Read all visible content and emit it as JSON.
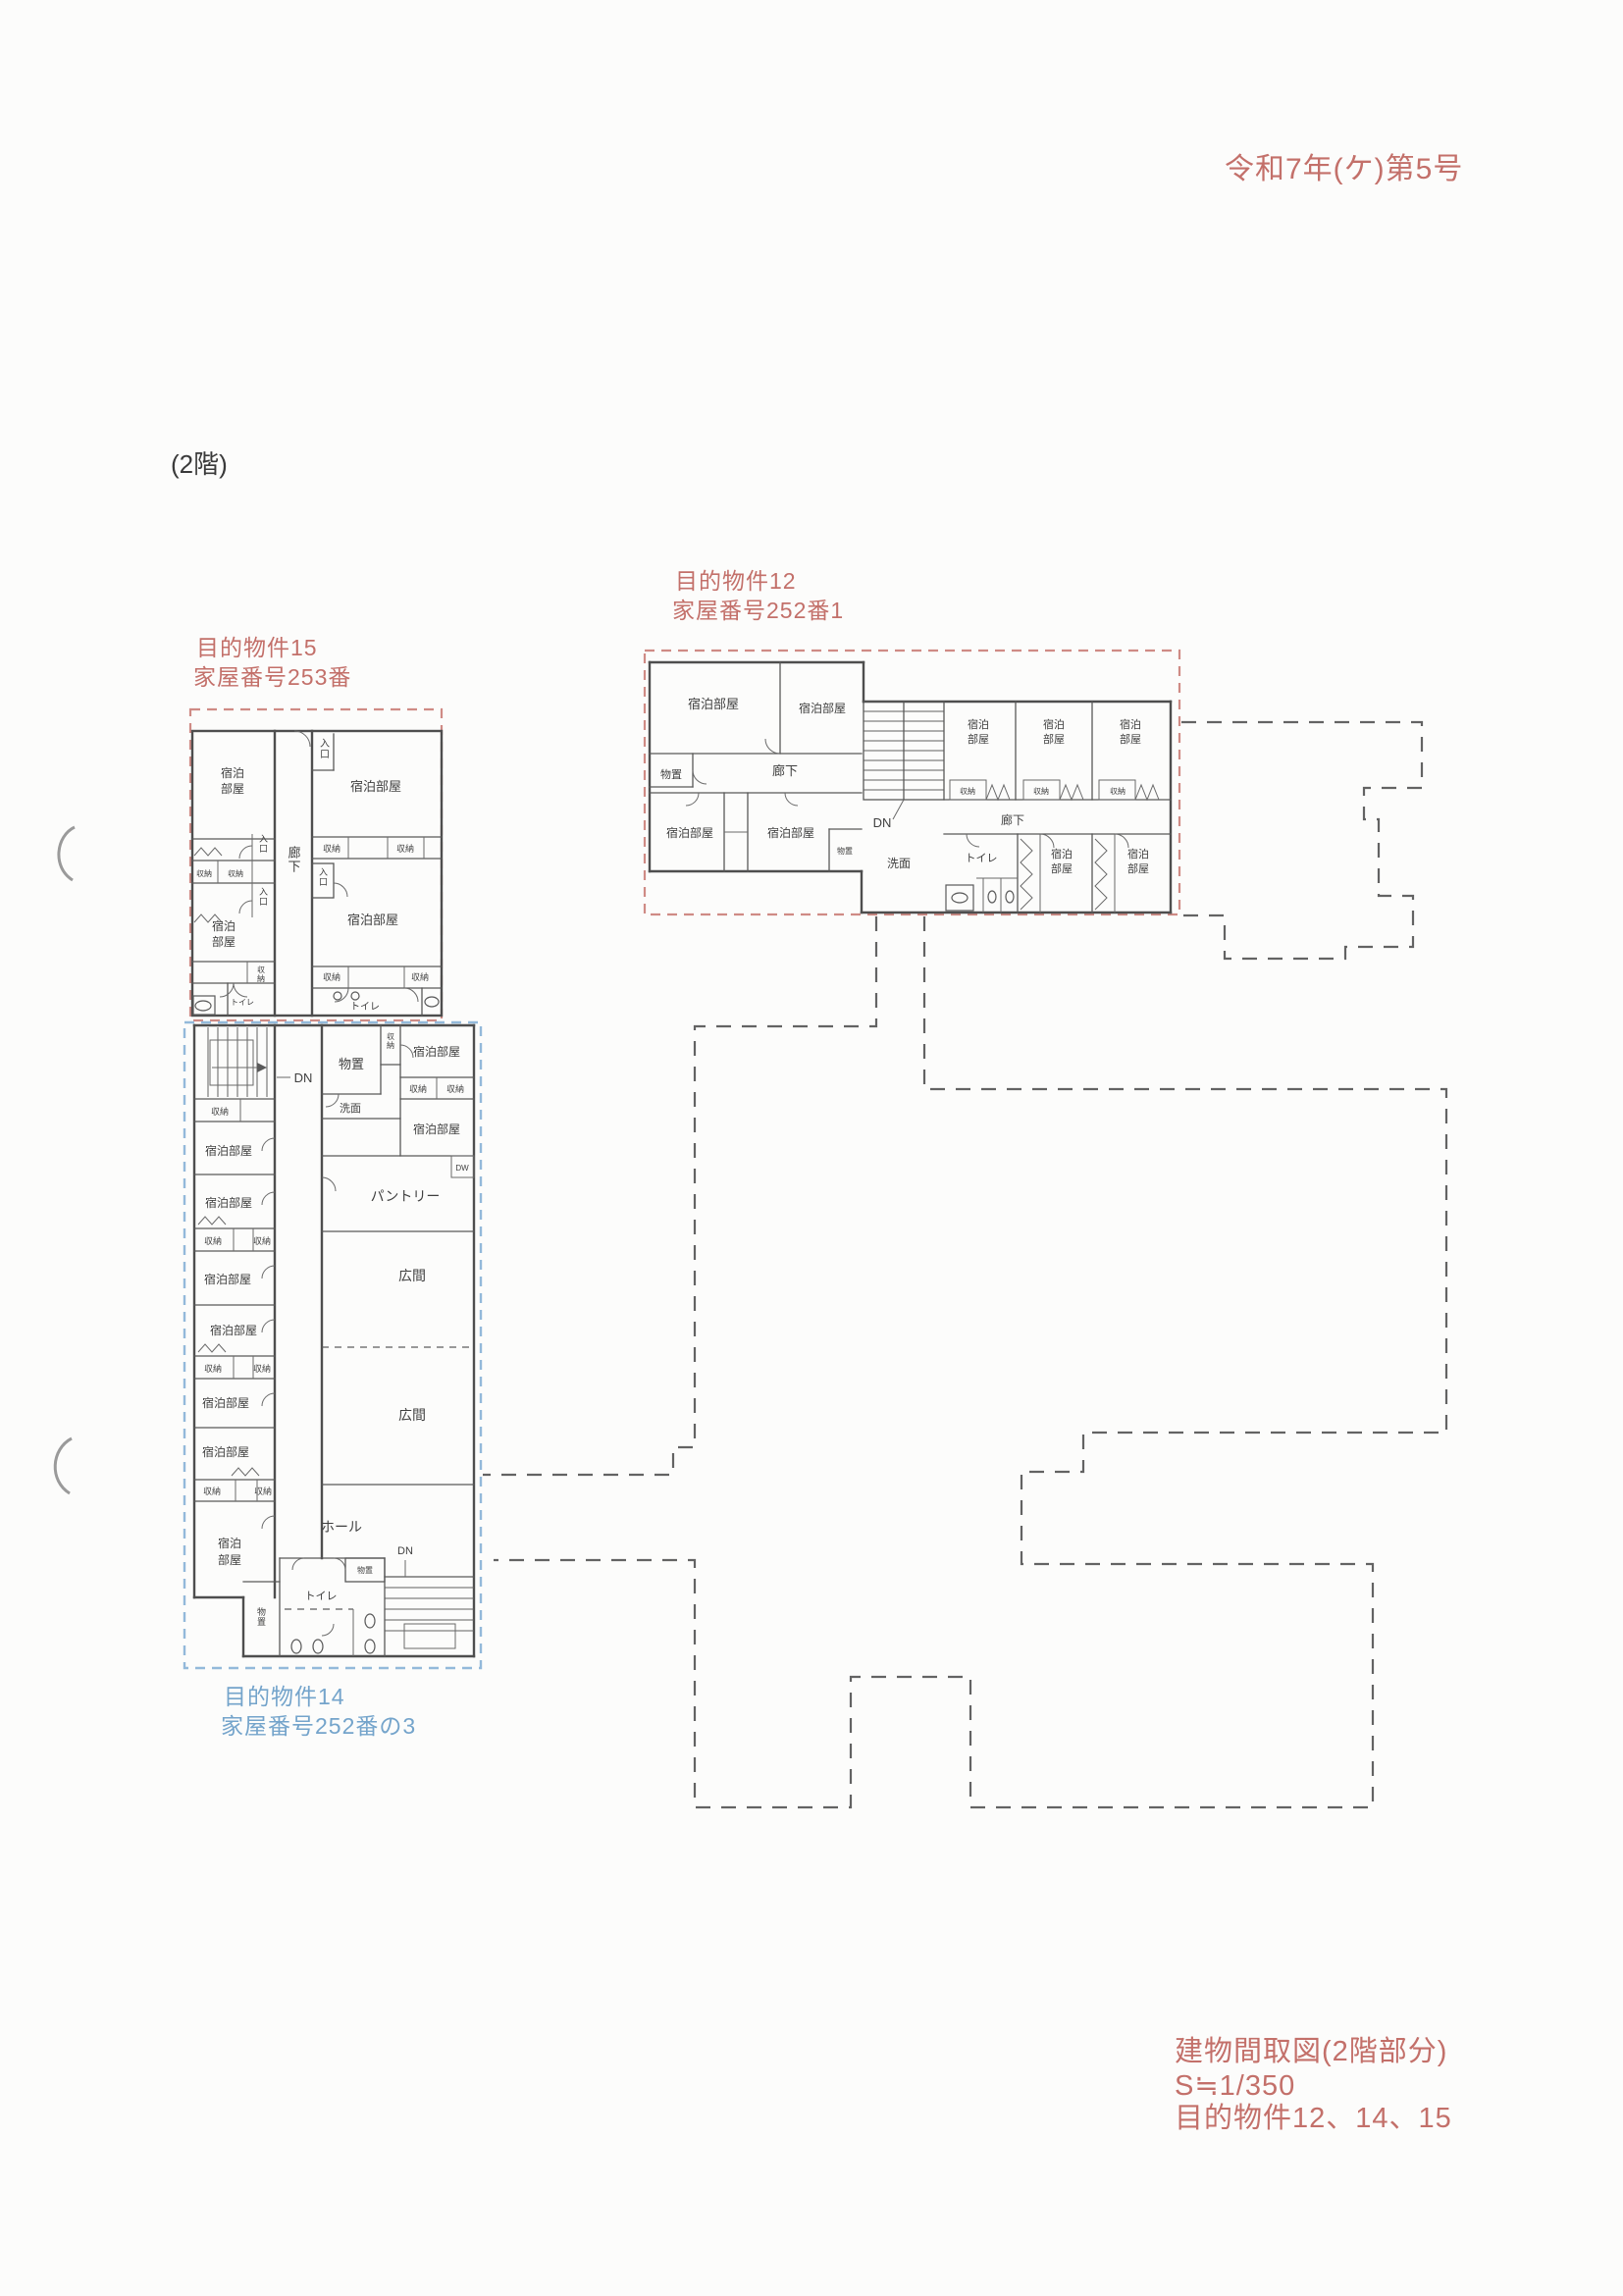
{
  "page": {
    "case_number": "令和7年(ケ)第5号",
    "floor_label": "(2階)",
    "footer": {
      "title": "建物間取図(2階部分)",
      "scale": "S≒1/350",
      "subjects": "目的物件12、14、15"
    },
    "colors": {
      "heading_red": "#c3706a",
      "boundary_red_dash": "#cf8b85",
      "label_blue": "#74a4cb",
      "boundary_blue_dash": "#93b9da",
      "outline_gray_dash": "#636363",
      "wall_gray": "#4e4e4e"
    }
  },
  "property_labels": {
    "p15": {
      "l1": "目的物件15",
      "l2": "家屋番号253番"
    },
    "p12": {
      "l1": "目的物件12",
      "l2": "家屋番号252番1"
    },
    "p14": {
      "l1": "目的物件14",
      "l2": "家屋番号252番の3"
    }
  },
  "terms": {
    "guest_room": "宿泊部屋",
    "guest_room_l1": "宿泊",
    "guest_room_l2": "部屋",
    "storage": "収納",
    "entrance": "入口",
    "corridor": "廊下",
    "toilet": "トイレ",
    "storeroom": "物置",
    "washroom": "洗面",
    "pantry": "パントリー",
    "hall_hiroma": "広間",
    "hall_katakana": "ホール",
    "down": "DN",
    "dw": "DW"
  }
}
